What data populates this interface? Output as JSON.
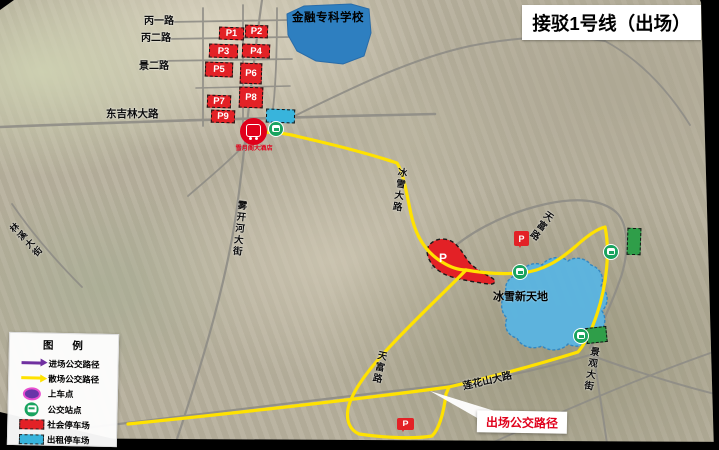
{
  "title": "接驳1号线（出场）",
  "legend": {
    "title": "图 例",
    "items": [
      {
        "icon": "arrow-purple-icon",
        "label": "进场公交路径"
      },
      {
        "icon": "arrow-yellow-icon",
        "label": "散场公交路径"
      },
      {
        "icon": "boarding-point-icon",
        "label": "上车点"
      },
      {
        "icon": "bus-stop-icon",
        "label": "公交站点"
      },
      {
        "icon": "public-parking-icon",
        "label": "社会停车场"
      },
      {
        "icon": "taxi-parking-icon",
        "label": "出租停车场"
      }
    ]
  },
  "map": {
    "school_label": "金融专科学校",
    "venue_label": "冰雪新天地",
    "exit_route_callout": "出场公交路径",
    "boarding_stop_name": "雪月阁大酒店",
    "parking_blob_label": "P",
    "parking_flag_label": "P",
    "parking_lots": [
      "P1",
      "P2",
      "P3",
      "P4",
      "P5",
      "P6",
      "P7",
      "P8",
      "P9"
    ],
    "road_labels": [
      "丙一路",
      "丙二路",
      "景二路",
      "东吉林大路",
      "雾开河大街",
      "林溪大街",
      "冰雪大路",
      "天富路",
      "天富路",
      "莲花山大路",
      "景观大街"
    ]
  },
  "colors": {
    "exit_route": "#ffe200",
    "enter_route": "#7030a0",
    "public_parking": "#e32126",
    "taxi_parking": "#38b4dc",
    "green_parking": "#2f9e49",
    "bus_stop": "#19a35f",
    "boarding_marker": "#e0001b",
    "school_fill": "#2e7fc0",
    "venue_fill": "#5ab5e2",
    "callout_text": "#e0001b"
  }
}
